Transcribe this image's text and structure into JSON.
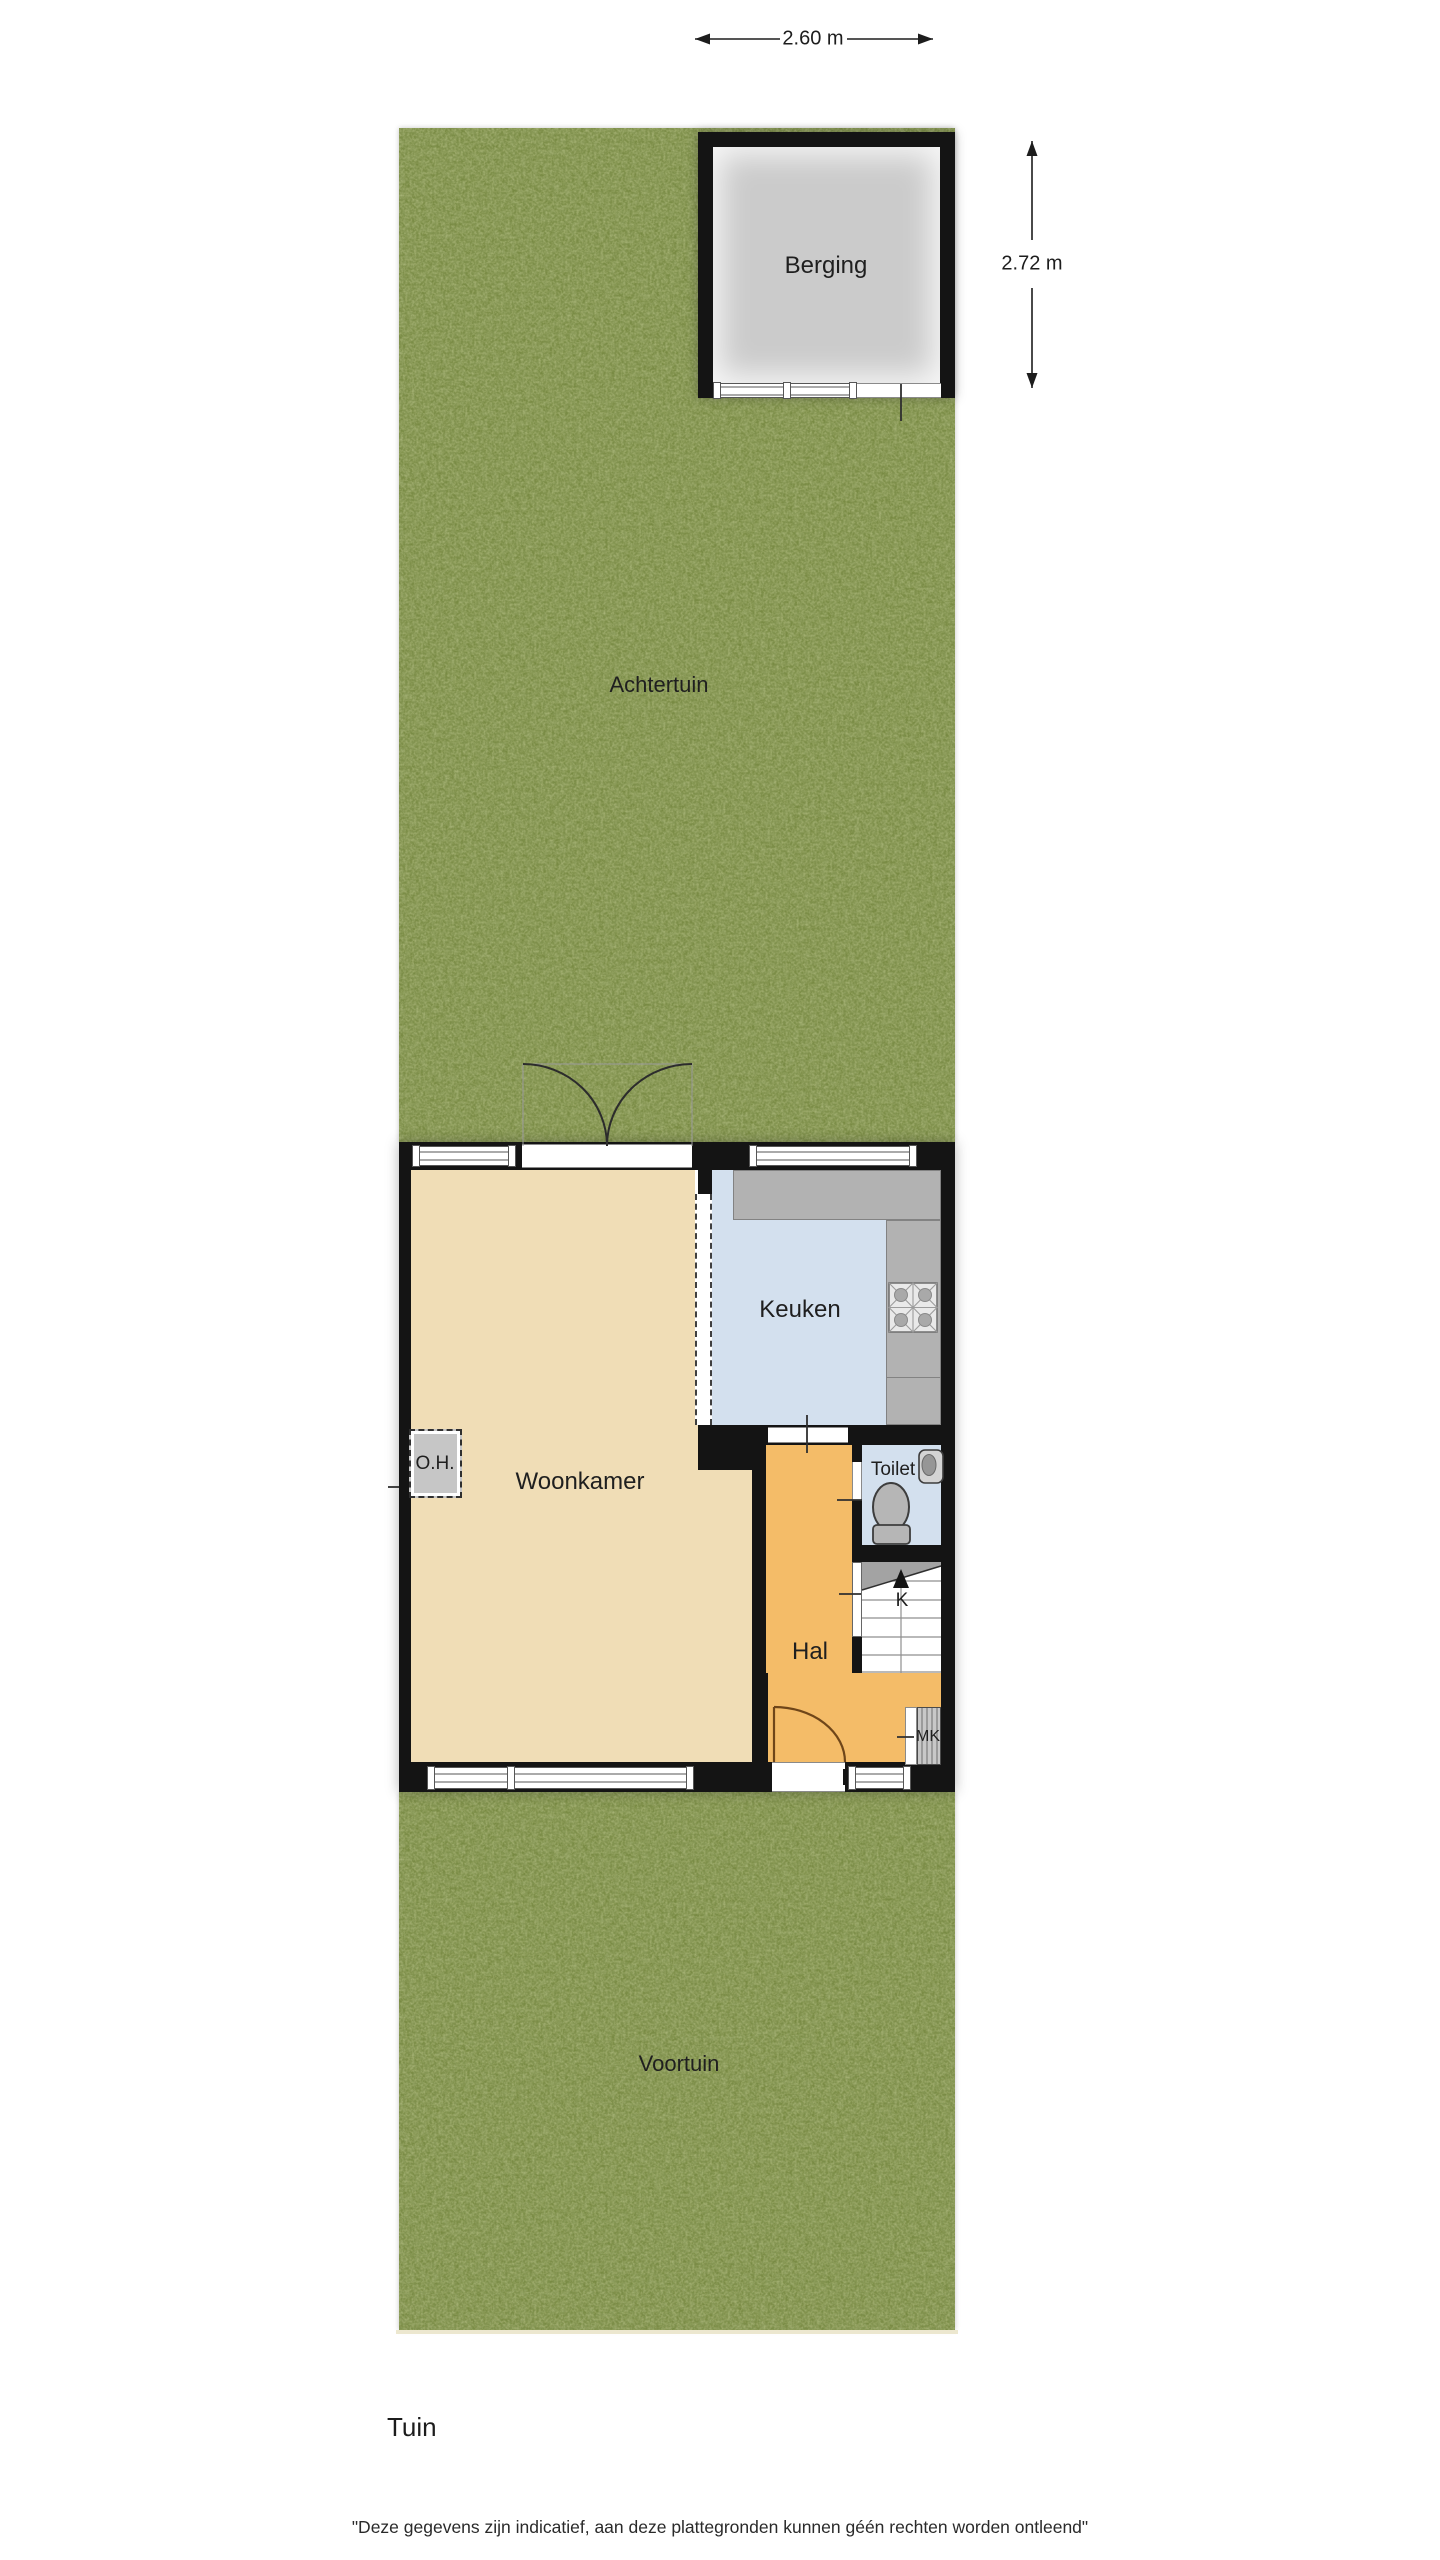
{
  "title": {
    "text": "Tuin"
  },
  "disclaimer": {
    "text": "\"Deze gegevens zijn indicatief, aan deze plattegronden kunnen géén rechten worden ontleend\""
  },
  "dimensions": {
    "width": {
      "label": "2.60 m"
    },
    "height": {
      "label": "2.72 m"
    }
  },
  "rooms": {
    "achtertuin": {
      "label": "Achtertuin"
    },
    "voortuin": {
      "label": "Voortuin"
    },
    "berging": {
      "label": "Berging"
    },
    "woonkamer": {
      "label": "Woonkamer"
    },
    "keuken": {
      "label": "Keuken"
    },
    "hal": {
      "label": "Hal"
    },
    "toilet": {
      "label": "Toilet"
    },
    "meterkast": {
      "label": "MK"
    },
    "open_haard": {
      "label": "O.H."
    },
    "stairs": {
      "label": "K"
    }
  },
  "colors": {
    "grass": "#788a43",
    "curb": "#ece7cf",
    "wall": "#141414",
    "berging_floor": "#cbcbcb",
    "woonkamer_floor": "#f0ddb6",
    "keuken_floor": "#d3e0ee",
    "hal_floor": "#f4bc68",
    "toilet_floor": "#d3e0ee",
    "counter": "#b2b2b2",
    "stairs_shade": "#a3a3a3",
    "door_arc": "#6f4619",
    "frame": "#565656",
    "label": "#1f1f1f"
  }
}
